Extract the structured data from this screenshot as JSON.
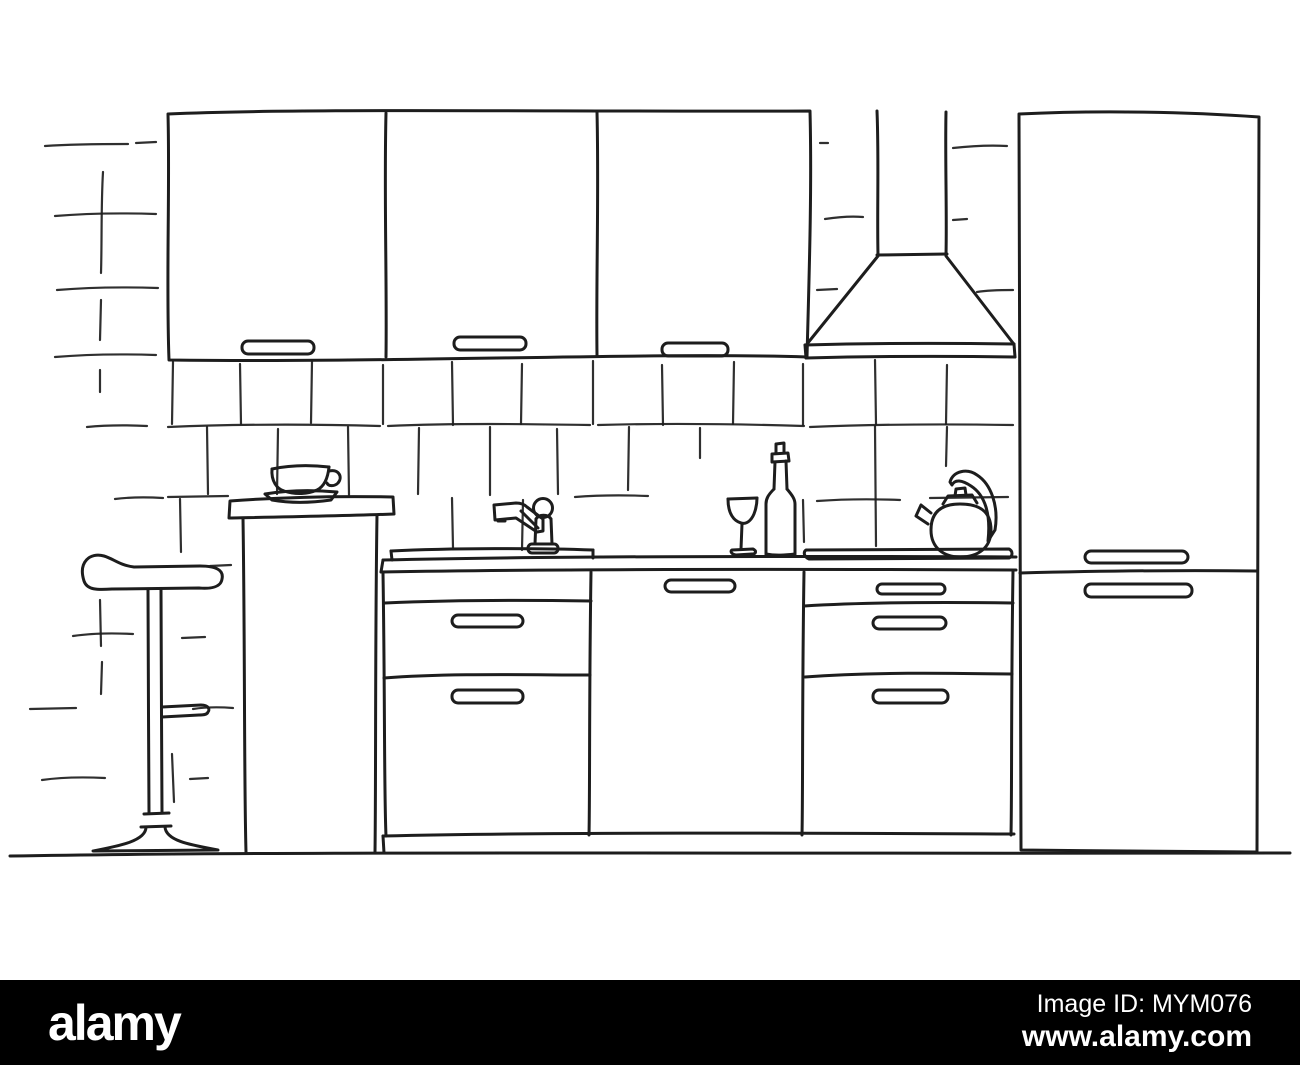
{
  "footer": {
    "brand": "alamy",
    "image_id": "Image ID: MYM076",
    "url": "www.alamy.com"
  },
  "colors": {
    "background": "#ffffff",
    "line": "#1d1d1d",
    "footer_background": "#000000",
    "footer_text": "#ffffff"
  },
  "scene": {
    "kind": "hand-drawn-kitchen-sketch",
    "elements": [
      "left-wall-tiles",
      "backsplash-tiles",
      "wall-cabinets",
      "range-hood",
      "tall-cabinet",
      "countertop",
      "sink-base-cabinet",
      "base-cabinet-door",
      "drawer-unit",
      "plinth",
      "floor-line",
      "bar-counter",
      "cup-and-saucer",
      "bar-stool",
      "faucet",
      "wine-glass",
      "bottle",
      "cooktop",
      "kettle"
    ]
  }
}
